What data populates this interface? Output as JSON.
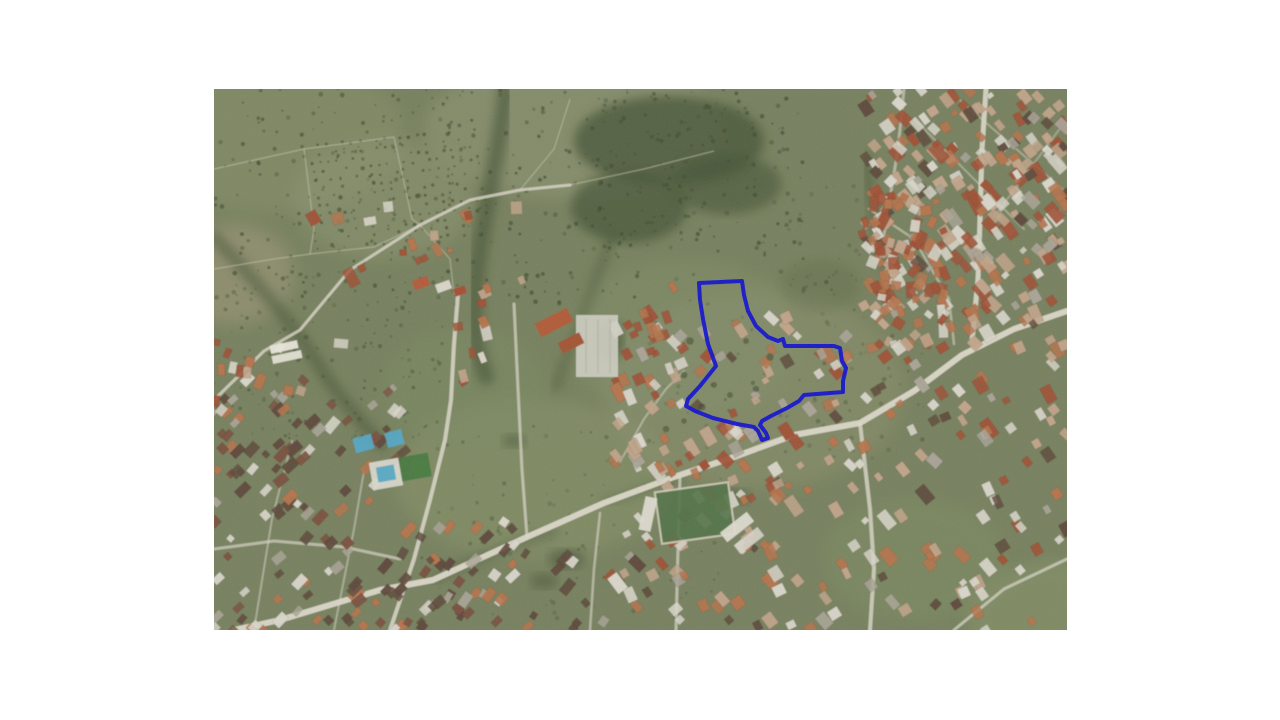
{
  "page": {
    "background_color": "#ffffff",
    "content": "satellite-map-screenshot"
  },
  "map": {
    "description": "Aerial satellite photograph of a semi-rural town: green fields and orchards on the upper left, dense red-roofed urban housing on the right and lower left, with a land parcel outlined in blue near the center-right",
    "position": {
      "x": 214,
      "y": 89,
      "width": 853,
      "height": 541
    },
    "colors": {
      "base_green": "#77815e",
      "field_light": "#8a9270",
      "field_pale": "#9c9678",
      "field_mid": "#818a66",
      "trees_dark": "#3f4c31",
      "blob_dark": "#475538",
      "road_light": "#dcd8c9",
      "road_soft": "#cfcbb8",
      "roof_tan": "#c2a58b",
      "roof_orange": "#b5744d",
      "roof_red": "#a05136",
      "roof_dark": "#5f4a3c",
      "roof_maroon": "#7a5140",
      "building_white": "#d9d6ca",
      "building_gray": "#a9a496",
      "pool_blue": "#55a8c4",
      "pitch_green": "#55754a",
      "parcel_blue": "#1414cd"
    },
    "parcel_overlay": {
      "label": "highlighted-parcel-boundary",
      "stroke_color": "#1414cd",
      "stroke_width": 4,
      "points": [
        [
          485,
          194
        ],
        [
          528,
          192
        ],
        [
          530,
          206
        ],
        [
          534,
          222
        ],
        [
          542,
          237
        ],
        [
          554,
          248
        ],
        [
          564,
          252
        ],
        [
          569,
          250
        ],
        [
          571,
          257
        ],
        [
          620,
          257
        ],
        [
          626,
          259
        ],
        [
          628,
          272
        ],
        [
          632,
          279
        ],
        [
          629,
          292
        ],
        [
          629,
          303
        ],
        [
          590,
          306
        ],
        [
          585,
          312
        ],
        [
          573,
          319
        ],
        [
          557,
          327
        ],
        [
          548,
          332
        ],
        [
          546,
          336
        ],
        [
          552,
          344
        ],
        [
          554,
          349
        ],
        [
          548,
          351
        ],
        [
          544,
          342
        ],
        [
          540,
          338
        ],
        [
          523,
          335
        ],
        [
          499,
          329
        ],
        [
          481,
          322
        ],
        [
          472,
          317
        ],
        [
          474,
          310
        ],
        [
          486,
          297
        ],
        [
          498,
          282
        ],
        [
          502,
          277
        ],
        [
          494,
          255
        ],
        [
          489,
          230
        ],
        [
          486,
          211
        ]
      ]
    }
  }
}
